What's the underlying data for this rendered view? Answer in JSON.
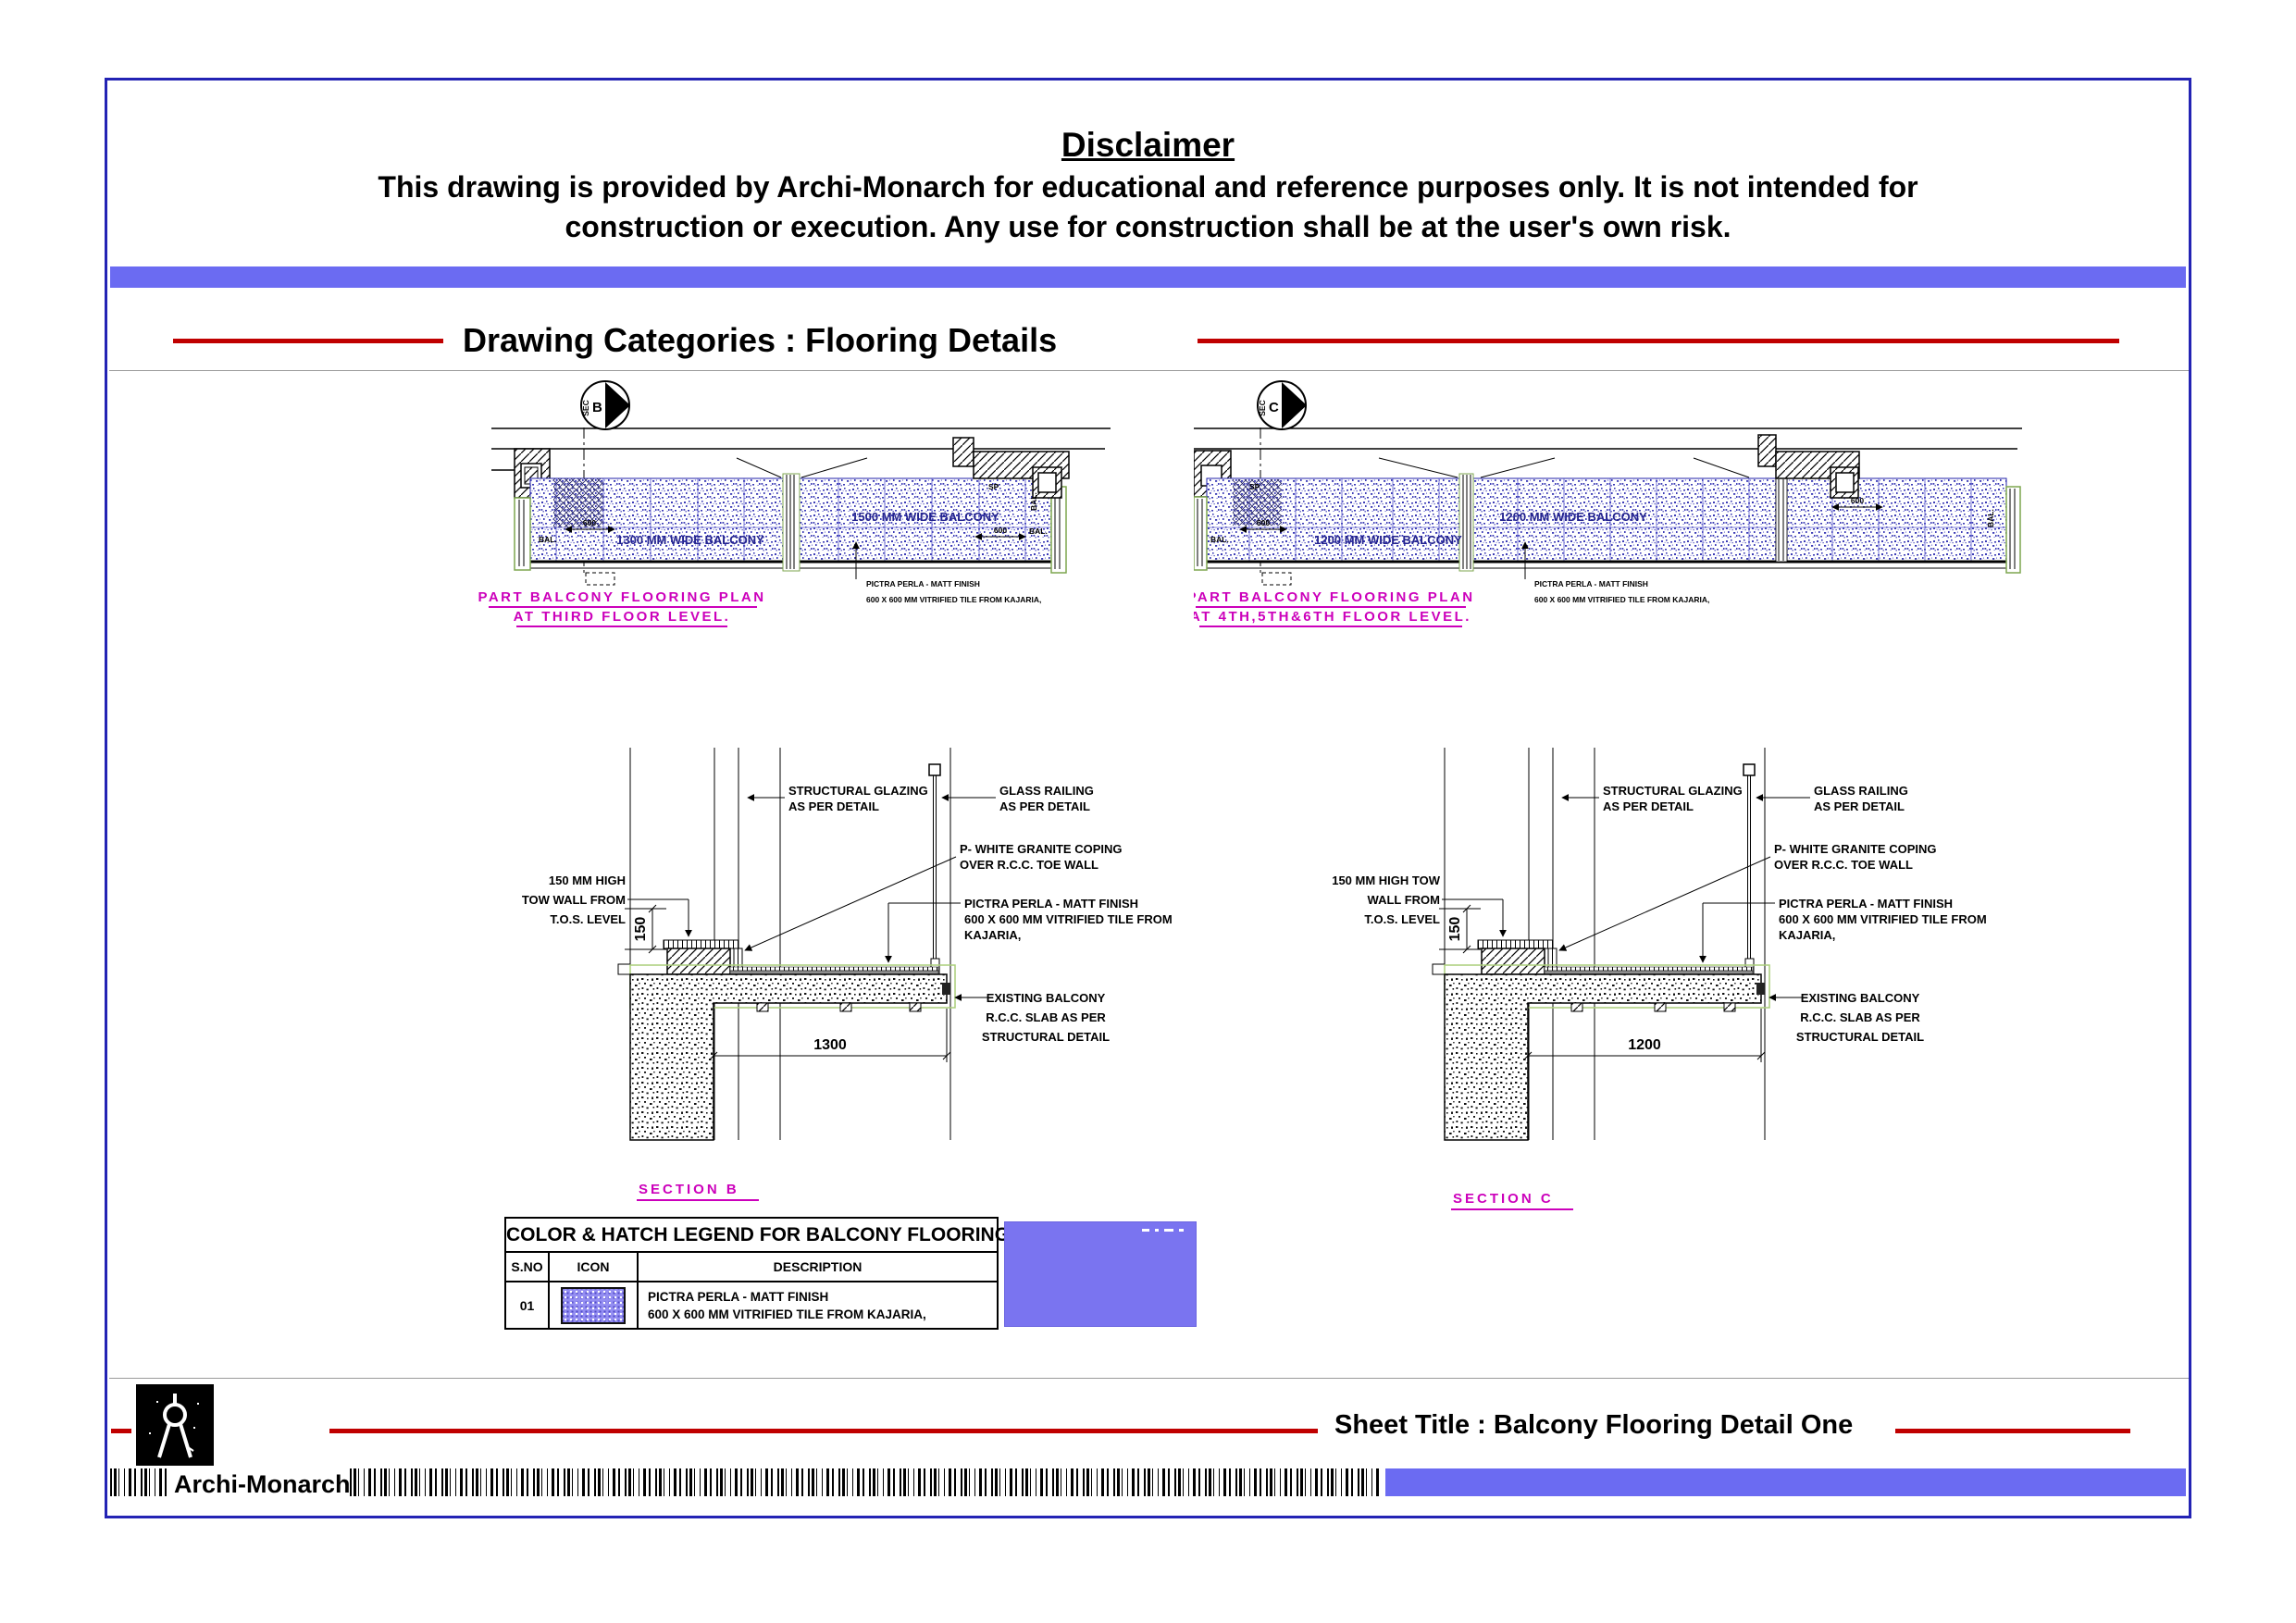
{
  "disclaimer": {
    "title": "Disclaimer",
    "line1": "This drawing is provided by Archi-Monarch for educational and reference purposes only. It is not intended for",
    "line2": "construction or execution. Any use for construction shall be at the user's own risk."
  },
  "header": {
    "category_label": "Drawing Categories : Flooring Details"
  },
  "plans": {
    "common": {
      "sec": "SEC",
      "dim600": "600",
      "bal": "BAL.",
      "sp": "SP",
      "note1": "PICTRA PERLA - MATT FINISH",
      "note2": "600 X 600 MM VITRIFIED TILE FROM KAJARIA,"
    },
    "plan1": {
      "letter": "B",
      "bay1_label": "1300 MM WIDE BALCONY",
      "bay2_label": "1500 MM WIDE BALCONY",
      "title_line1": "PART BALCONY FLOORING PLAN",
      "title_line2": "AT THIRD FLOOR LEVEL."
    },
    "plan2": {
      "letter": "C",
      "bay1_label": "1200 MM WIDE BALCONY",
      "bay2_label": "1200 MM WIDE BALCONY",
      "title_line1": "PART BALCONY FLOORING PLAN",
      "title_line2": "AT 4TH,5TH&6TH FLOOR LEVEL."
    }
  },
  "sections": {
    "common": {
      "glazing1": "STRUCTURAL GLAZING",
      "glazing2": "AS PER DETAIL",
      "railing1": "GLASS RAILING",
      "railing2": "AS PER DETAIL",
      "coping1": "P- WHITE GRANITE COPING",
      "coping2": "OVER R.C.C. TOE WALL",
      "tile1": "PICTRA PERLA - MATT FINISH",
      "tile2": "600 X 600 MM VITRIFIED TILE FROM",
      "tile3": "KAJARIA,",
      "slab1": "EXISTING BALCONY",
      "slab2": "R.C.C. SLAB AS PER",
      "slab3": "STRUCTURAL DETAIL",
      "dim150": "150"
    },
    "b": {
      "tow1": "150 MM HIGH",
      "tow2": "TOW WALL FROM",
      "tow3": "T.O.S. LEVEL",
      "dim_width": "1300",
      "title": "SECTION B"
    },
    "c": {
      "tow1": "150 MM HIGH TOW",
      "tow2": "WALL FROM",
      "tow3": "T.O.S. LEVEL",
      "dim_width": "1200",
      "title": "SECTION C"
    }
  },
  "legend": {
    "title": "COLOR & HATCH LEGEND FOR BALCONY FLOORING",
    "col_sno": "S.NO",
    "col_icon": "ICON",
    "col_desc": "DESCRIPTION",
    "row_sno": "01",
    "row_desc1": "PICTRA PERLA - MATT FINISH",
    "row_desc2": "600 X 600 MM VITRIFIED TILE FROM KAJARIA,"
  },
  "footer": {
    "sheet_title": "Sheet Title : Balcony Flooring Detail One",
    "brand": "Archi-Monarch"
  },
  "colors": {
    "accent_bar": "#6b6bf2",
    "red_rule": "#c00000",
    "magenta": "#cc00bb",
    "border_blue": "#2323b4",
    "swatch": "#7a74f0",
    "bay_text": "#23238e"
  }
}
